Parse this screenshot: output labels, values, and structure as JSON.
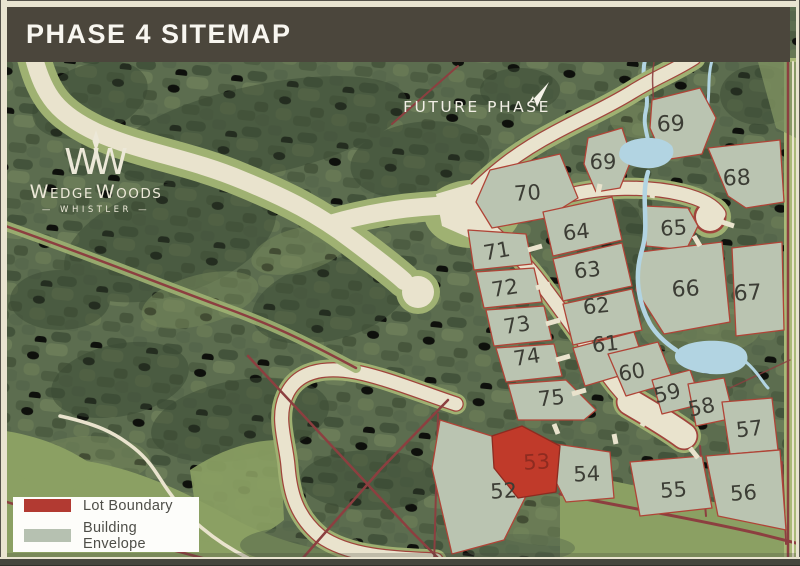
{
  "header": {
    "title": "PHASE 4 SITEMAP"
  },
  "logo": {
    "monogram_left": "W",
    "monogram_right": "W",
    "name_w1": "W",
    "name_edge": "EDGE",
    "name_w2": "W",
    "name_oods": "OODS",
    "subtitle": "— WHISTLER —"
  },
  "map": {
    "future_phase_label": "FUTURE PHASE",
    "highlight_lot": "53",
    "lots": [
      {
        "num": "52",
        "x": 504,
        "y": 498,
        "rot": -3
      },
      {
        "num": "53",
        "x": 537,
        "y": 469,
        "rot": -3,
        "highlight": true
      },
      {
        "num": "54",
        "x": 587,
        "y": 481,
        "rot": -2
      },
      {
        "num": "55",
        "x": 674,
        "y": 497,
        "rot": -4
      },
      {
        "num": "56",
        "x": 744,
        "y": 500,
        "rot": -4
      },
      {
        "num": "57",
        "x": 750,
        "y": 436,
        "rot": -6
      },
      {
        "num": "58",
        "x": 703,
        "y": 414,
        "rot": -12
      },
      {
        "num": "59",
        "x": 669,
        "y": 400,
        "rot": -14
      },
      {
        "num": "60",
        "x": 633,
        "y": 379,
        "rot": -10
      },
      {
        "num": "61",
        "x": 606,
        "y": 351,
        "rot": -6
      },
      {
        "num": "62",
        "x": 597,
        "y": 313,
        "rot": -6
      },
      {
        "num": "63",
        "x": 588,
        "y": 277,
        "rot": -6
      },
      {
        "num": "64",
        "x": 577,
        "y": 239,
        "rot": -6
      },
      {
        "num": "65",
        "x": 674,
        "y": 235,
        "rot": -3
      },
      {
        "num": "66",
        "x": 686,
        "y": 296,
        "rot": -3,
        "size": 22
      },
      {
        "num": "67",
        "x": 748,
        "y": 300,
        "rot": -3,
        "size": 22
      },
      {
        "num": "68",
        "x": 737,
        "y": 185,
        "rot": -2,
        "size": 22
      },
      {
        "num": "69",
        "x": 671,
        "y": 131,
        "rot": -2,
        "size": 22
      },
      {
        "num": "69",
        "x": 603,
        "y": 169,
        "rot": 0
      },
      {
        "num": "70",
        "x": 528,
        "y": 200,
        "rot": -4
      },
      {
        "num": "71",
        "x": 498,
        "y": 258,
        "rot": -10
      },
      {
        "num": "72",
        "x": 506,
        "y": 295,
        "rot": -9
      },
      {
        "num": "73",
        "x": 518,
        "y": 332,
        "rot": -9
      },
      {
        "num": "74",
        "x": 528,
        "y": 364,
        "rot": -9
      },
      {
        "num": "75",
        "x": 552,
        "y": 405,
        "rot": -6
      }
    ],
    "colors": {
      "lot_fill": "#bac4b1",
      "lot_stroke": "#b04437",
      "highlight_fill": "#c03a2a",
      "highlight_text": "#8e2b20",
      "label_text": "#3c3d35",
      "water": "#b2d4e2",
      "road": "#e9e3cd",
      "boundary": "#8c3f40"
    }
  },
  "legend": {
    "items": [
      {
        "label": "Lot Boundary",
        "color": "#b23a32"
      },
      {
        "label": "Building Envelope",
        "color": "#b6c1b1"
      }
    ]
  }
}
